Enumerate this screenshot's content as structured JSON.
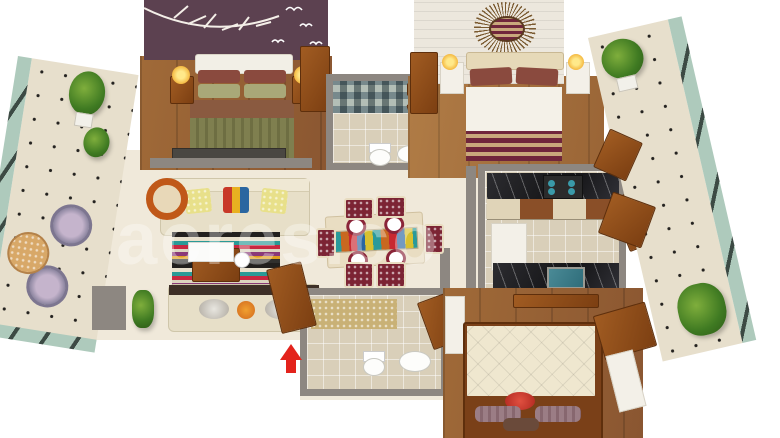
{
  "watermark": {
    "text": "acres.co"
  },
  "entry_arrow": {
    "direction": "up",
    "color": "#e3231c"
  },
  "palette": {
    "wall": "#8d8781",
    "wood_mid": "#a06a38",
    "wood_dark": "#8a5631",
    "wood_light": "#b07c46",
    "wood_door": "#a15c22",
    "floor_cream": "#f0e9da",
    "tile_beige": "#d9cfb9",
    "balcony_floor": "#e7dfcc",
    "glass": "#aecabc",
    "glass_bar": "#3c4a44",
    "purple_wall": "#5c4150",
    "panel_white": "#ece7dd",
    "gold_wall": "#c9b176",
    "maroon": "#7c2434",
    "sofa_cream": "#e7dfc8",
    "duvet_cream": "#efe7cf",
    "accent_red": "#e3231c",
    "teal": "#3a9aa8",
    "pillow_red": "#c22f26",
    "pillow_mauve": "#9b7d85",
    "pillow_maroon": "#8a4a3e",
    "bed_green": "#7f7f4f",
    "bed_brown": "#8a5a40",
    "orange_chair": "#c05818"
  },
  "scene": {
    "type": "3d-floor-plan-render",
    "rooms": [
      "bedroom-1",
      "bathroom-1",
      "bedroom-2",
      "kitchen",
      "dining",
      "living",
      "bathroom-2",
      "bedroom-3",
      "balcony-left",
      "balcony-right"
    ]
  }
}
